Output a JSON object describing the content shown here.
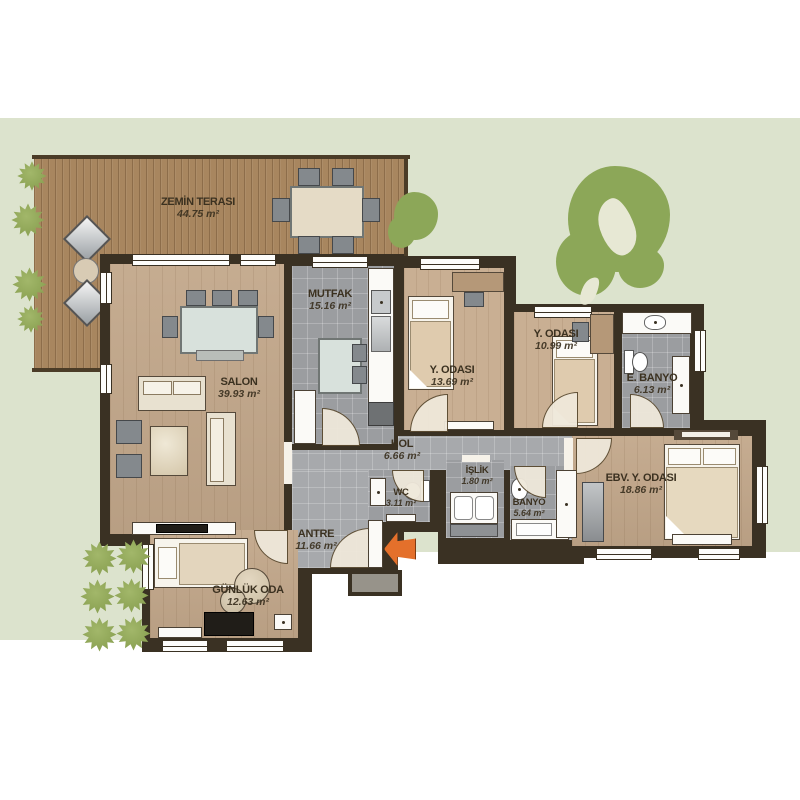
{
  "plan": {
    "rooms": [
      {
        "id": "zemin-terasi",
        "name": "ZEMİN TERASI",
        "area": "44.75 m²"
      },
      {
        "id": "salon",
        "name": "SALON",
        "area": "39.93 m²"
      },
      {
        "id": "mutfak",
        "name": "MUTFAK",
        "area": "15.16 m²"
      },
      {
        "id": "y-odasi-1",
        "name": "Y. ODASI",
        "area": "13.69 m²"
      },
      {
        "id": "y-odasi-2",
        "name": "Y. ODASI",
        "area": "10.99 m²"
      },
      {
        "id": "e-banyo",
        "name": "E. BANYO",
        "area": "6.13 m²"
      },
      {
        "id": "hol",
        "name": "HOL",
        "area": "6.66 m²"
      },
      {
        "id": "wc",
        "name": "WC",
        "area": "3.11 m²"
      },
      {
        "id": "islik",
        "name": "İŞLİK",
        "area": "1.80 m²"
      },
      {
        "id": "banyo",
        "name": "BANYO",
        "area": "5.64 m²"
      },
      {
        "id": "ebv-y-odasi",
        "name": "EBV. Y. ODASI",
        "area": "18.86 m²"
      },
      {
        "id": "antre",
        "name": "ANTRE",
        "area": "11.66 m²"
      },
      {
        "id": "gunluk-oda",
        "name": "GÜNLÜK ODA",
        "area": "12.63 m²"
      }
    ],
    "colors": {
      "ground": "#dce3cd",
      "wall": "#3a3123",
      "deck_wood": "#a8865f",
      "room_wood": "#c2a78a",
      "tile": "#9b9da0",
      "greenery": "#8ca758",
      "entrance_arrow": "#e4702b",
      "label_text": "#3b3120"
    }
  }
}
